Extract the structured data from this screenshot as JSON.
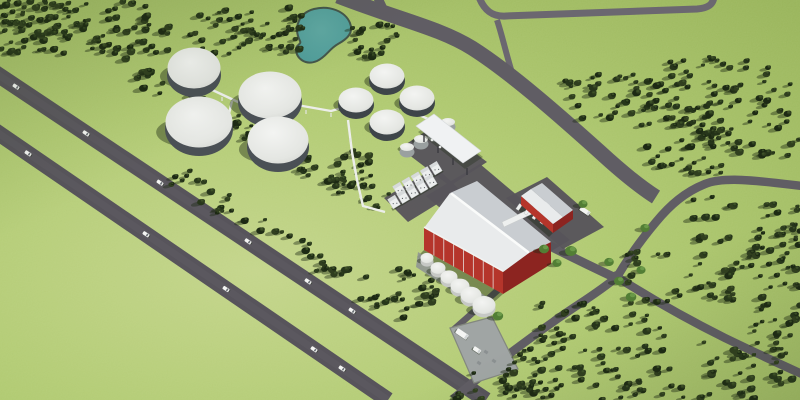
{
  "scene": {
    "kind": "aerial-3d-render",
    "subject": "biogas-plant-site-rendering",
    "width": 800,
    "height": 400
  },
  "palette": {
    "grass_center": "#c3d48a",
    "grass_mid": "#afc96f",
    "grass_edge": "#96b257",
    "road_dark": "#57545b",
    "road_mid": "#605d64",
    "road_light": "#6b6770",
    "pad_light": "#a0a5a4",
    "pond_fill": "#4f9c99",
    "pond_light": "#5fa8a3",
    "pond_rim": "#44564b",
    "tree_dark": "#1d2a14",
    "tree_main": "#27361b",
    "tree_alt": "#303f1f",
    "tree_hi": "#41562a",
    "tree_green": "#527e35",
    "tree_green_hi": "#6b9a49",
    "shadow": "rgba(28,40,20,0.42)",
    "dome_hi": "#f3f4f2",
    "dome_lo": "#d5d7d3",
    "tank_base": "#4a5055",
    "dark_tank_wall": "#3e4549",
    "white_tank": "#eef0ed",
    "white_tank_shade": "#c6c8c5",
    "barn_red": "#b5352b",
    "barn_red_dark": "#8c2420",
    "roof_sw": "#e9ebec",
    "roof_ne": "#c9cdd1",
    "ridge_white": "#fafbfa",
    "unit_white": "#eceeee",
    "unit_top": "#d7dadb",
    "vehicle_white": "#f4f5f3",
    "vehicle_glass": "#494f55",
    "crate_gray": "#8b9091"
  },
  "pond": {
    "path": "M 300,41 C 293,27 299,13 314,9 C 329,5 345,11 350,23 C 354,33 347,39 338,44 C 329,49 327,56 317,61 C 305,66 296,58 296,49 C 296,45 302,44 300,41 Z"
  },
  "highway": {
    "width": 16,
    "road_a": {
      "x1": -12,
      "y1": 68,
      "x2": 486,
      "y2": 400
    },
    "road_b": {
      "x1": -12,
      "y1": 126,
      "x2": 388,
      "y2": 400
    },
    "cars_a": [
      16,
      86,
      160,
      248,
      308,
      352
    ],
    "cars_b": [
      28,
      146,
      226,
      314,
      342
    ],
    "car_angle": 34
  },
  "roads": [
    {
      "name": "top-road",
      "d": "M 479,-3 C 484,10 492,17 506,16 L 697,9 C 709,8 713,4 714,-3",
      "w": 7,
      "tone": "road_light"
    },
    {
      "name": "top-road-branch",
      "d": "M 497,20 C 503,38 507,58 514,79",
      "w": 6,
      "tone": "road_light"
    },
    {
      "name": "main-access-road",
      "d": "M 338,-4 C 400,20 440,28 472,48 C 510,72 560,116 600,152 C 625,175 645,190 656,197",
      "w": 15,
      "tone": "road_mid"
    },
    {
      "name": "fork-stub",
      "d": "M 377,-4 L 385,13",
      "w": 9,
      "tone": "road_mid"
    },
    {
      "name": "east-s-road",
      "d": "M 802,186 C 760,181 725,176 705,184 C 685,192 670,205 656,222 C 645,235 630,255 617,277",
      "w": 8.5,
      "tone": "road_mid"
    },
    {
      "name": "southwest-road",
      "d": "M 617,277 C 595,295 575,306 553,322 C 520,345 490,368 453,399",
      "w": 8.5,
      "tone": "road_mid"
    },
    {
      "name": "southeast-road",
      "d": "M 617,277 C 650,298 685,318 725,338 C 752,351 775,362 802,374",
      "w": 8.5,
      "tone": "road_mid"
    },
    {
      "name": "plant-spine-road",
      "d": "M 516,228 C 556,250 590,266 620,280",
      "w": 9,
      "tone": "road_mid"
    },
    {
      "name": "pad-access-road",
      "d": "M 549,246 C 525,266 500,288 478,308 C 468,317 460,324 452,331",
      "w": 6.5,
      "tone": "road_mid"
    }
  ],
  "intersection": {
    "cx": 617,
    "cy": 277,
    "r": 6
  },
  "pads": [
    {
      "name": "equipment-pad",
      "pts": "384,198 436,167 460,190 408,222"
    },
    {
      "name": "canopy-pad",
      "pts": "400,148 437,124 487,162 450,186"
    },
    {
      "name": "barn-yard",
      "pts": "426,196 480,164 570,240 516,272"
    },
    {
      "name": "loading-pad",
      "pts": "506,198 547,177 604,227 563,249"
    }
  ],
  "truck_pad": {
    "pts": "450,328 492,317 518,369 474,383",
    "crates": [
      [
        486,
        352
      ],
      [
        494,
        361
      ],
      [
        479,
        363
      ]
    ],
    "trucks": [
      {
        "x": 462,
        "y": 334,
        "l": 13,
        "w": 5.5,
        "a": 34
      },
      {
        "x": 477,
        "y": 350,
        "l": 8,
        "w": 4.2,
        "a": 34
      }
    ]
  },
  "digesters": [
    {
      "cx": 194,
      "cy": 68,
      "rx": 27,
      "ry": 22
    },
    {
      "cx": 270,
      "cy": 95,
      "rx": 32,
      "ry": 25
    },
    {
      "cx": 199,
      "cy": 122,
      "rx": 34,
      "ry": 27
    },
    {
      "cx": 278,
      "cy": 140,
      "rx": 31,
      "ry": 25
    }
  ],
  "medium_tanks": {
    "rx": 18,
    "ry": 14,
    "items": [
      {
        "cx": 387,
        "cy": 76
      },
      {
        "cx": 356,
        "cy": 100
      },
      {
        "cx": 417,
        "cy": 98
      },
      {
        "cx": 387,
        "cy": 122
      }
    ]
  },
  "small_tanks": {
    "rx": 7.5,
    "ry": 5.5,
    "items": [
      {
        "cx": 407,
        "cy": 147
      },
      {
        "cx": 421,
        "cy": 139
      },
      {
        "cx": 435,
        "cy": 131
      },
      {
        "cx": 448,
        "cy": 122
      }
    ]
  },
  "front_tanks": {
    "pad": "418,252 490,299 488,314 416,267",
    "items": [
      {
        "cx": 427,
        "cy": 258,
        "r": 6.5
      },
      {
        "cx": 438,
        "cy": 268,
        "r": 7.5
      },
      {
        "cx": 449,
        "cy": 277,
        "r": 8.5
      },
      {
        "cx": 460,
        "cy": 286,
        "r": 9.5
      },
      {
        "cx": 471,
        "cy": 295,
        "r": 10.5
      },
      {
        "cx": 484,
        "cy": 305,
        "r": 11.5
      }
    ]
  },
  "equipment_units": {
    "angle": -31,
    "w": 8.5,
    "h": 11,
    "rows": [
      {
        "x": 399,
        "y": 189,
        "n": 5,
        "dx": 9.2,
        "dy": -5.2
      },
      {
        "x": 394,
        "y": 202,
        "n": 5,
        "dx": 9.2,
        "dy": -5.2
      }
    ]
  },
  "canopy": {
    "roof": "416,126 434,114 481,151 463,163",
    "shadow": "418,132 436,120 483,157 465,169",
    "legs": [
      [
        424,
        135
      ],
      [
        438,
        146
      ],
      [
        453,
        158
      ],
      [
        467,
        168
      ]
    ],
    "drums": [
      [
        432,
        140
      ],
      [
        440,
        147
      ]
    ],
    "truck": {
      "x": 460,
      "y": 154,
      "l": 13,
      "w": 5,
      "a": 34
    }
  },
  "barn": {
    "shadow": "424,250 503,294 494,302 417,257",
    "wall": "424,228 503,272 503,294 424,250",
    "gable": "503,272 530,252 551,242 551,264 503,294",
    "roof_sw": "450,193 529,253 503,272 424,228",
    "roof_ne": "450,193 529,253 551,242 477,181",
    "ridge": {
      "x1": 452,
      "y1": 194,
      "x2": 528,
      "y2": 252
    },
    "eave": {
      "x1": 424,
      "y1": 227,
      "x2": 503,
      "y2": 271
    },
    "stripes": 7
  },
  "loading": {
    "shadow": "521,205 553,233 549,237 517,209",
    "wall": "521,196 553,224 553,233 521,205",
    "gable": "553,224 563,217 573,210 573,219 553,233",
    "roof_sw": "531,189 563,217 553,224 521,196",
    "roof_ne": "531,189 563,217 573,210 542,183",
    "docks": [
      [
        519,
        207
      ],
      [
        527,
        211.6
      ],
      [
        535,
        216.2
      ],
      [
        543,
        220.8
      ]
    ],
    "strip": "502,222 549,200 551,205 504,227",
    "truck": {
      "x": 585,
      "y": 211,
      "l": 11,
      "w": 4.5,
      "a": 34
    }
  },
  "pipe_racks": {
    "paths": [
      "M 206,87 L 238,102 L 263,99 L 331,111 L 355,104 L 371,101",
      "M 348,120 L 352,152 L 357,180 L 363,206 L 385,212",
      "M 232,101 L 228,118",
      "M 404,108 L 428,119"
    ],
    "posts": [
      [
        222,
        97
      ],
      [
        250,
        102
      ],
      [
        280,
        106
      ],
      [
        306,
        110
      ],
      [
        331,
        113
      ],
      [
        355,
        106
      ],
      [
        350,
        138
      ],
      [
        354,
        166
      ],
      [
        360,
        194
      ]
    ]
  },
  "tree_clusters": [
    {
      "name": "top-band-west",
      "x": 0,
      "y": 2,
      "w": 150,
      "h": 52,
      "n": 85
    },
    {
      "name": "top-band-east",
      "x": 145,
      "y": 8,
      "w": 160,
      "h": 46,
      "n": 60
    },
    {
      "name": "top-left-corner",
      "x": 0,
      "y": 0,
      "w": 70,
      "h": 34,
      "n": 25
    },
    {
      "name": "pond-east",
      "x": 352,
      "y": 22,
      "w": 46,
      "h": 36,
      "n": 20
    },
    {
      "name": "near-canopy-west",
      "x": 330,
      "y": 150,
      "w": 45,
      "h": 45,
      "n": 15
    },
    {
      "name": "below-containers",
      "x": 392,
      "y": 268,
      "w": 48,
      "h": 52,
      "n": 20
    },
    {
      "name": "forest-nw",
      "x": 565,
      "y": 70,
      "w": 115,
      "h": 52,
      "n": 48
    },
    {
      "name": "forest-ne",
      "x": 668,
      "y": 56,
      "w": 132,
      "h": 100,
      "n": 85
    },
    {
      "name": "forest-mid",
      "x": 640,
      "y": 122,
      "w": 85,
      "h": 55,
      "n": 32
    },
    {
      "name": "below-s-road",
      "x": 692,
      "y": 196,
      "w": 108,
      "h": 80,
      "n": 45
    },
    {
      "name": "above-se-road",
      "x": 622,
      "y": 252,
      "w": 118,
      "h": 48,
      "n": 30
    },
    {
      "name": "bottom-forest",
      "x": 540,
      "y": 300,
      "w": 145,
      "h": 100,
      "n": 75
    },
    {
      "name": "pad-south",
      "x": 455,
      "y": 368,
      "w": 88,
      "h": 32,
      "n": 20
    },
    {
      "name": "bottom-mid",
      "x": 505,
      "y": 348,
      "w": 60,
      "h": 50,
      "n": 22
    },
    {
      "name": "corner-se",
      "x": 700,
      "y": 342,
      "w": 100,
      "h": 58,
      "n": 38
    },
    {
      "name": "right-edge-mid",
      "x": 768,
      "y": 232,
      "w": 32,
      "h": 58,
      "n": 13
    },
    {
      "name": "right-blob",
      "x": 752,
      "y": 288,
      "w": 48,
      "h": 52,
      "n": 17
    }
  ],
  "tree_strips": [
    {
      "name": "diagonal-treeline-upper",
      "x1": 118,
      "y1": 66,
      "x2": 390,
      "y2": 205,
      "hw": 11,
      "n": 65
    },
    {
      "name": "roadside-treeline",
      "x1": 170,
      "y1": 172,
      "x2": 392,
      "y2": 305,
      "hw": 11,
      "n": 48
    }
  ],
  "green_trees": [
    [
      544,
      249
    ],
    [
      557,
      263
    ],
    [
      571,
      251
    ],
    [
      619,
      281
    ],
    [
      631,
      297
    ],
    [
      641,
      270
    ],
    [
      583,
      204
    ],
    [
      609,
      262
    ],
    [
      645,
      228
    ],
    [
      498,
      316
    ]
  ]
}
